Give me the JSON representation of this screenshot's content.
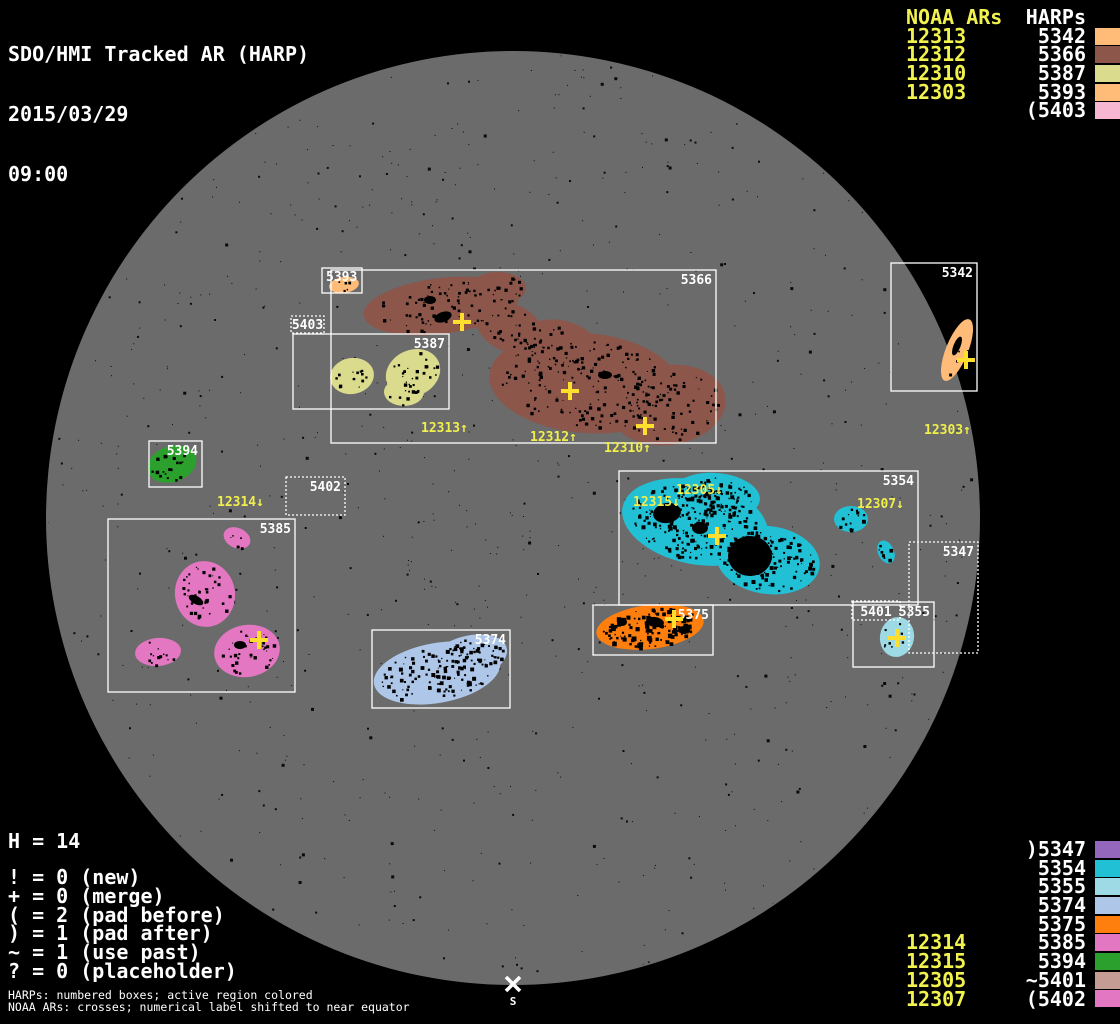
{
  "header": {
    "title": "SDO/HMI Tracked AR (HARP)",
    "date": "2015/03/29",
    "time": "09:00"
  },
  "colors": {
    "background": "#000000",
    "disk": "#6b6b6b",
    "box_stroke": "#ffffff",
    "noaa_text": "#f2f24f",
    "cross": "#ffdf2e",
    "speck": "#000000"
  },
  "top_right_table": {
    "noaa_header": "NOAA ARs",
    "harp_header": "HARPs",
    "rows": [
      {
        "noaa": "12313",
        "harp": "5342",
        "color": "#ffbb78"
      },
      {
        "noaa": "12312",
        "harp": "5366",
        "color": "#8c564b"
      },
      {
        "noaa": "12310",
        "harp": "5387",
        "color": "#dbdb8d"
      },
      {
        "noaa": "12303",
        "harp": "5393",
        "color": "#ffbb78"
      },
      {
        "noaa": "",
        "harp": "(5403",
        "color": "#f7b6d2"
      }
    ]
  },
  "bottom_right_table": {
    "rows": [
      {
        "noaa": "",
        "harp": ")5347",
        "color": "#9467bd"
      },
      {
        "noaa": "",
        "harp": "5354",
        "color": "#22c0d5"
      },
      {
        "noaa": "",
        "harp": "5355",
        "color": "#9edae5"
      },
      {
        "noaa": "",
        "harp": "5374",
        "color": "#aec7e8"
      },
      {
        "noaa": "",
        "harp": "5375",
        "color": "#ff7f0e"
      },
      {
        "noaa": "12314",
        "harp": "5385",
        "color": "#e377c2"
      },
      {
        "noaa": "12315",
        "harp": "5394",
        "color": "#2ca02c"
      },
      {
        "noaa": "12305",
        "harp": "~5401",
        "color": "#c49c94"
      },
      {
        "noaa": "12307",
        "harp": "(5402",
        "color": "#e377c2"
      }
    ]
  },
  "stats": {
    "h_line": "H = 14",
    "lines": [
      "! = 0 (new)",
      "+ = 0 (merge)",
      "( = 2 (pad before)",
      ") = 1 (pad after)",
      "~ = 1 (use past)",
      "? = 0 (placeholder)"
    ]
  },
  "footnotes": [
    "HARPs: numbered boxes; active region colored",
    "NOAA ARs: crosses; numerical label shifted to near equator"
  ],
  "south_label": "S",
  "disk": {
    "cx": 513,
    "cy": 518,
    "r": 467
  },
  "south_marker": {
    "x": 513,
    "y": 984
  },
  "harp_boxes": [
    {
      "label": "5342",
      "x": 891,
      "y": 263,
      "w": 86,
      "h": 128,
      "style": "solid",
      "anchor": "tr"
    },
    {
      "label": "5366",
      "x": 331,
      "y": 270,
      "w": 385,
      "h": 173,
      "style": "solid",
      "anchor": "tr"
    },
    {
      "label": "5393",
      "x": 322,
      "y": 268,
      "w": 40,
      "h": 25,
      "style": "solid",
      "anchor": "tl"
    },
    {
      "label": "5403",
      "x": 291,
      "y": 316,
      "w": 33,
      "h": 17,
      "style": "dotted",
      "anchor": "fill"
    },
    {
      "label": "5387",
      "x": 293,
      "y": 334,
      "w": 156,
      "h": 75,
      "style": "solid",
      "anchor": "tr"
    },
    {
      "label": "5394",
      "x": 149,
      "y": 441,
      "w": 53,
      "h": 46,
      "style": "solid",
      "anchor": "tr"
    },
    {
      "label": "5402",
      "x": 286,
      "y": 477,
      "w": 59,
      "h": 38,
      "style": "dotted",
      "anchor": "tr"
    },
    {
      "label": "5385",
      "x": 108,
      "y": 519,
      "w": 187,
      "h": 173,
      "style": "solid",
      "anchor": "tr"
    },
    {
      "label": "5374",
      "x": 372,
      "y": 630,
      "w": 138,
      "h": 78,
      "style": "solid",
      "anchor": "tr"
    },
    {
      "label": "5354",
      "x": 619,
      "y": 471,
      "w": 299,
      "h": 134,
      "style": "solid",
      "anchor": "tr"
    },
    {
      "label": "5375",
      "x": 593,
      "y": 605,
      "w": 120,
      "h": 50,
      "style": "solid",
      "anchor": "tr"
    },
    {
      "label": "5355",
      "x": 853,
      "y": 602,
      "w": 81,
      "h": 65,
      "style": "solid",
      "anchor": "tr"
    },
    {
      "label": "5401",
      "x": 852,
      "y": 601,
      "w": 48,
      "h": 19,
      "style": "dotted",
      "anchor": "fill"
    },
    {
      "label": "5347",
      "x": 909,
      "y": 542,
      "w": 69,
      "h": 111,
      "style": "dotted",
      "anchor": "tr"
    }
  ],
  "noaa_labels": [
    {
      "text": "12313↑",
      "x": 421,
      "y": 432
    },
    {
      "text": "12312↑",
      "x": 530,
      "y": 441
    },
    {
      "text": "12310↑",
      "x": 604,
      "y": 452
    },
    {
      "text": "12303↑",
      "x": 924,
      "y": 434
    },
    {
      "text": "12314↓",
      "x": 217,
      "y": 506
    },
    {
      "text": "12315↓",
      "x": 633,
      "y": 506
    },
    {
      "text": "12305↓",
      "x": 676,
      "y": 494
    },
    {
      "text": "12307↓",
      "x": 857,
      "y": 508
    }
  ],
  "crosses": [
    {
      "x": 462,
      "y": 322
    },
    {
      "x": 570,
      "y": 391
    },
    {
      "x": 645,
      "y": 426
    },
    {
      "x": 966,
      "y": 360
    },
    {
      "x": 717,
      "y": 536
    },
    {
      "x": 259,
      "y": 640
    },
    {
      "x": 674,
      "y": 619
    },
    {
      "x": 897,
      "y": 638
    }
  ],
  "regions": [
    {
      "harp": "5366",
      "color": "#8c564b",
      "speck": 30,
      "speckMax": 2.5,
      "blobs": [
        {
          "cx": 441,
          "cy": 306,
          "rx": 78,
          "ry": 28,
          "rot": -7
        },
        {
          "cx": 510,
          "cy": 328,
          "rx": 36,
          "ry": 24,
          "rot": 25
        },
        {
          "cx": 585,
          "cy": 383,
          "rx": 96,
          "ry": 50,
          "rot": 5
        },
        {
          "cx": 668,
          "cy": 405,
          "rx": 58,
          "ry": 40,
          "rot": -8
        },
        {
          "cx": 558,
          "cy": 348,
          "rx": 42,
          "ry": 28,
          "rot": 10
        },
        {
          "cx": 498,
          "cy": 288,
          "rx": 28,
          "ry": 16,
          "rot": 0
        }
      ]
    },
    {
      "harp": "5387",
      "color": "#dbdb8d",
      "speck": 28,
      "speckMax": 2.5,
      "blobs": [
        {
          "cx": 352,
          "cy": 376,
          "rx": 22,
          "ry": 18,
          "rot": -10
        },
        {
          "cx": 413,
          "cy": 373,
          "rx": 28,
          "ry": 23,
          "rot": -25
        },
        {
          "cx": 404,
          "cy": 392,
          "rx": 20,
          "ry": 14,
          "rot": 0
        }
      ]
    },
    {
      "harp": "5393",
      "color": "#ffbb78",
      "speck": 25,
      "speckMax": 2,
      "blobs": [
        {
          "cx": 344,
          "cy": 285,
          "rx": 15,
          "ry": 8,
          "rot": -8
        }
      ]
    },
    {
      "harp": "5342",
      "color": "#ffbb78",
      "speck": 60,
      "speckMax": 2,
      "blobs": [
        {
          "cx": 957,
          "cy": 350,
          "rx": 11,
          "ry": 33,
          "rot": 22
        }
      ]
    },
    {
      "harp": "5394",
      "color": "#2ca02c",
      "speck": 22,
      "speckMax": 2.5,
      "blobs": [
        {
          "cx": 172,
          "cy": 464,
          "rx": 25,
          "ry": 18,
          "rot": -18
        }
      ]
    },
    {
      "harp": "5385",
      "color": "#e377c2",
      "speck": 24,
      "speckMax": 2.5,
      "blobs": [
        {
          "cx": 237,
          "cy": 538,
          "rx": 14,
          "ry": 10,
          "rot": 25
        },
        {
          "cx": 205,
          "cy": 594,
          "rx": 30,
          "ry": 33,
          "rot": -10
        },
        {
          "cx": 158,
          "cy": 652,
          "rx": 23,
          "ry": 14,
          "rot": -5
        },
        {
          "cx": 247,
          "cy": 651,
          "rx": 33,
          "ry": 26,
          "rot": -10
        }
      ]
    },
    {
      "harp": "5374",
      "color": "#aec7e8",
      "speck": 18,
      "speckMax": 3,
      "blobs": [
        {
          "cx": 437,
          "cy": 673,
          "rx": 64,
          "ry": 30,
          "rot": -10
        },
        {
          "cx": 468,
          "cy": 658,
          "rx": 40,
          "ry": 22,
          "rot": -15
        }
      ]
    },
    {
      "harp": "5354",
      "color": "#22c0d5",
      "speck": 14,
      "speckMax": 3,
      "blobs": [
        {
          "cx": 695,
          "cy": 522,
          "rx": 74,
          "ry": 42,
          "rot": 12
        },
        {
          "cx": 768,
          "cy": 560,
          "rx": 52,
          "ry": 34,
          "rot": 8
        },
        {
          "cx": 716,
          "cy": 496,
          "rx": 44,
          "ry": 23,
          "rot": 5
        },
        {
          "cx": 851,
          "cy": 519,
          "rx": 17,
          "ry": 13,
          "rot": 0
        },
        {
          "cx": 886,
          "cy": 552,
          "rx": 8,
          "ry": 12,
          "rot": -25
        }
      ]
    },
    {
      "harp": "5375",
      "color": "#ff7f0e",
      "speck": 10,
      "speckMax": 4,
      "blobs": [
        {
          "cx": 650,
          "cy": 627,
          "rx": 54,
          "ry": 22,
          "rot": -7
        }
      ]
    },
    {
      "harp": "5355",
      "color": "#9edae5",
      "speck": 40,
      "speckMax": 2,
      "blobs": [
        {
          "cx": 897,
          "cy": 637,
          "rx": 17,
          "ry": 20,
          "rot": 10
        }
      ]
    }
  ],
  "dark_spots": [
    {
      "cx": 443,
      "cy": 317,
      "rx": 9,
      "ry": 5,
      "rot": -20
    },
    {
      "cx": 750,
      "cy": 556,
      "rx": 22,
      "ry": 20,
      "rot": 0
    },
    {
      "cx": 667,
      "cy": 513,
      "rx": 14,
      "ry": 10,
      "rot": -10
    },
    {
      "cx": 700,
      "cy": 528,
      "rx": 8,
      "ry": 6,
      "rot": 0
    },
    {
      "cx": 196,
      "cy": 600,
      "rx": 8,
      "ry": 4,
      "rot": 30
    },
    {
      "cx": 655,
      "cy": 622,
      "rx": 9,
      "ry": 5,
      "rot": 10
    },
    {
      "cx": 684,
      "cy": 630,
      "rx": 6,
      "ry": 4,
      "rot": 0
    },
    {
      "cx": 622,
      "cy": 622,
      "rx": 5,
      "ry": 4,
      "rot": 0
    },
    {
      "cx": 957,
      "cy": 346,
      "rx": 3.5,
      "ry": 10,
      "rot": 22
    },
    {
      "cx": 240,
      "cy": 645,
      "rx": 6,
      "ry": 4,
      "rot": 0
    },
    {
      "cx": 430,
      "cy": 300,
      "rx": 6,
      "ry": 4,
      "rot": 0
    },
    {
      "cx": 605,
      "cy": 375,
      "rx": 7,
      "ry": 4,
      "rot": 0
    }
  ],
  "chart_data": {
    "type": "table",
    "title": "SDO/HMI Tracked AR (HARP) 2015/03/29 09:00",
    "harp_count": 14,
    "noaa_to_harp": [
      {
        "noaa": "12313",
        "harp": "5342"
      },
      {
        "noaa": "12312",
        "harp": "5366"
      },
      {
        "noaa": "12310",
        "harp": "5387"
      },
      {
        "noaa": "12303",
        "harp": "5393"
      },
      {
        "noaa": "12314",
        "harp": "5385"
      },
      {
        "noaa": "12315",
        "harp": "5394"
      },
      {
        "noaa": "12305",
        "harp": "5401"
      },
      {
        "noaa": "12307",
        "harp": "5402"
      }
    ],
    "flags": {
      "new": 0,
      "merge": 0,
      "pad_before": 2,
      "pad_after": 1,
      "use_past": 1,
      "placeholder": 0
    }
  }
}
